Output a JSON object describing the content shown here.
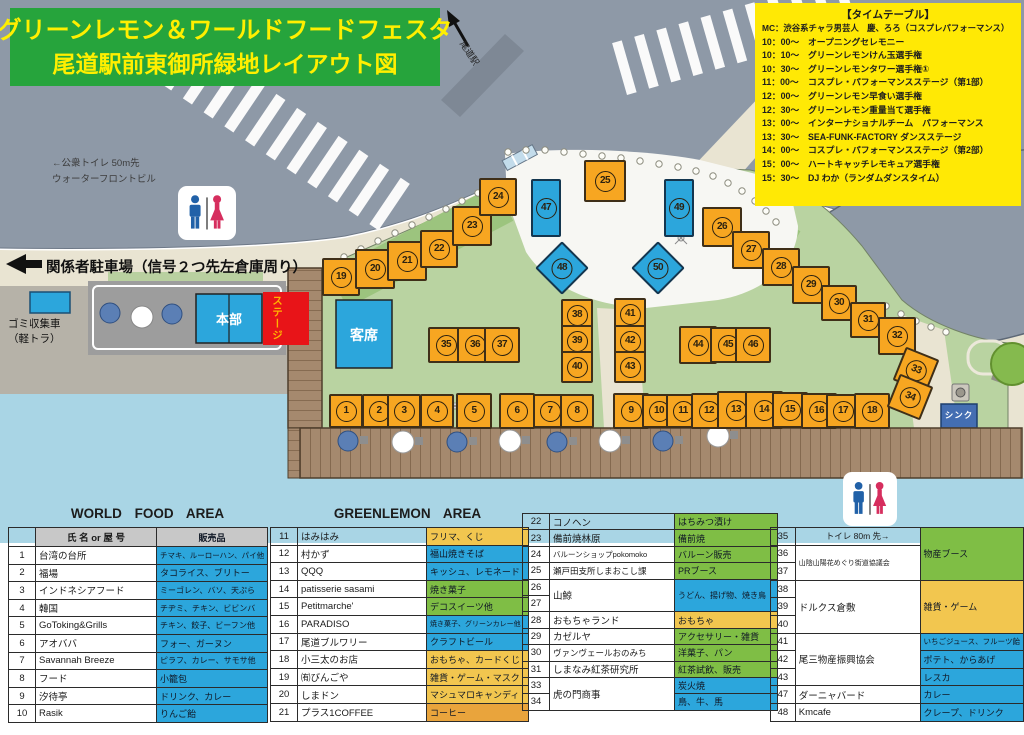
{
  "title": {
    "line1": "グリーンレモン＆ワールドフードフェスタ",
    "line2": "尾道駅前東御所緑地レイアウト図"
  },
  "timetable": {
    "heading": "【タイムテーブル】",
    "mc": "MC：渋谷系チャラ男芸人　慶、ろろ（コスプレパフォーマンス）",
    "entries": [
      {
        "time": "10：00～",
        "event": "オープニングセレモニー"
      },
      {
        "time": "10：10～",
        "event": "グリーンレモンけん玉選手権"
      },
      {
        "time": "10：30～",
        "event": "グリーンレモンタワー選手権①"
      },
      {
        "time": "11：00～",
        "event": "コスプレ・パフォーマンスステージ（第1部）"
      },
      {
        "time": "12：00～",
        "event": "グリーンレモン早食い選手権"
      },
      {
        "time": "12：30～",
        "event": "グリーンレモン重量当て選手権"
      },
      {
        "time": "13：00～",
        "event": "インターナショナルチーム　パフォーマンス"
      },
      {
        "time": "13：30～",
        "event": "SEA-FUNK-FACTORY ダンスステージ"
      },
      {
        "time": "14：00～",
        "event": "コスプレ・パフォーマンスステージ（第2部）"
      },
      {
        "time": "15：00～",
        "event": "ハートキャッチレモキュア選手権"
      },
      {
        "time": "15：30～",
        "event": "DJ わか（ランダムダンスタイム）"
      }
    ]
  },
  "map": {
    "labels": {
      "public_toilet_line1": "←公衆トイレ 50m先",
      "public_toilet_line2": "ウォーターフロントビル",
      "staff_parking": "関係者駐車場（信号２つ先左倉庫周り）",
      "garbage_truck_line1": "ゴミ収集車",
      "garbage_truck_line2": "（軽トラ）",
      "headquarters": "本部",
      "stage": "ステージ",
      "audience_seats": "客席",
      "sink": "シンク",
      "station": "尾道駅"
    },
    "booths": [
      {
        "n": 1,
        "x": 346,
        "y": 411,
        "s": 34,
        "k": "o"
      },
      {
        "n": 2,
        "x": 379,
        "y": 411,
        "s": 34,
        "k": "o"
      },
      {
        "n": 3,
        "x": 404,
        "y": 411,
        "s": 34,
        "k": "o"
      },
      {
        "n": 4,
        "x": 437,
        "y": 411,
        "s": 34,
        "k": "o"
      },
      {
        "n": 5,
        "x": 474,
        "y": 411,
        "s": 36,
        "k": "o"
      },
      {
        "n": 6,
        "x": 517,
        "y": 411,
        "s": 36,
        "k": "o"
      },
      {
        "n": 7,
        "x": 550,
        "y": 411,
        "s": 34,
        "k": "o"
      },
      {
        "n": 8,
        "x": 577,
        "y": 411,
        "s": 34,
        "k": "o"
      },
      {
        "n": 9,
        "x": 631,
        "y": 411,
        "s": 36,
        "k": "o"
      },
      {
        "n": 10,
        "x": 659,
        "y": 411,
        "s": 34,
        "k": "o"
      },
      {
        "n": 11,
        "x": 683,
        "y": 411,
        "s": 34,
        "k": "o"
      },
      {
        "n": 12,
        "x": 709,
        "y": 411,
        "s": 36,
        "k": "o"
      },
      {
        "n": 13,
        "x": 736,
        "y": 410,
        "s": 38,
        "k": "o"
      },
      {
        "n": 14,
        "x": 764,
        "y": 410,
        "s": 38,
        "k": "o"
      },
      {
        "n": 15,
        "x": 790,
        "y": 410,
        "s": 36,
        "k": "o"
      },
      {
        "n": 16,
        "x": 819,
        "y": 411,
        "s": 36,
        "k": "o"
      },
      {
        "n": 17,
        "x": 843,
        "y": 411,
        "s": 34,
        "k": "o"
      },
      {
        "n": 18,
        "x": 872,
        "y": 411,
        "s": 36,
        "k": "o"
      },
      {
        "n": 19,
        "x": 341,
        "y": 277,
        "s": 38,
        "k": "o"
      },
      {
        "n": 20,
        "x": 375,
        "y": 269,
        "s": 40,
        "k": "o"
      },
      {
        "n": 21,
        "x": 407,
        "y": 261,
        "s": 40,
        "k": "o"
      },
      {
        "n": 22,
        "x": 439,
        "y": 249,
        "s": 38,
        "k": "o"
      },
      {
        "n": 23,
        "x": 472,
        "y": 226,
        "s": 40,
        "k": "o"
      },
      {
        "n": 24,
        "x": 498,
        "y": 197,
        "s": 38,
        "k": "o"
      },
      {
        "n": 25,
        "x": 605,
        "y": 181,
        "s": 42,
        "k": "o"
      },
      {
        "n": 26,
        "x": 722,
        "y": 227,
        "s": 40,
        "k": "o"
      },
      {
        "n": 27,
        "x": 751,
        "y": 250,
        "s": 38,
        "k": "o"
      },
      {
        "n": 28,
        "x": 781,
        "y": 267,
        "s": 38,
        "k": "o"
      },
      {
        "n": 29,
        "x": 811,
        "y": 285,
        "s": 38,
        "k": "o"
      },
      {
        "n": 30,
        "x": 839,
        "y": 303,
        "s": 36,
        "k": "o"
      },
      {
        "n": 31,
        "x": 868,
        "y": 320,
        "s": 36,
        "k": "o"
      },
      {
        "n": 32,
        "x": 897,
        "y": 336,
        "s": 38,
        "k": "o"
      },
      {
        "n": 33,
        "x": 916,
        "y": 370,
        "s": 36,
        "k": "o",
        "rot": 22
      },
      {
        "n": 34,
        "x": 910,
        "y": 397,
        "s": 36,
        "k": "o",
        "rot": 22
      },
      {
        "n": 35,
        "x": 446,
        "y": 345,
        "s": 36,
        "k": "o"
      },
      {
        "n": 36,
        "x": 475,
        "y": 345,
        "s": 36,
        "k": "o"
      },
      {
        "n": 37,
        "x": 502,
        "y": 345,
        "s": 36,
        "k": "o"
      },
      {
        "n": 38,
        "x": 577,
        "y": 315,
        "s": 32,
        "k": "o"
      },
      {
        "n": 39,
        "x": 577,
        "y": 341,
        "s": 32,
        "k": "o"
      },
      {
        "n": 40,
        "x": 577,
        "y": 367,
        "s": 32,
        "k": "o"
      },
      {
        "n": 41,
        "x": 630,
        "y": 314,
        "s": 32,
        "k": "o"
      },
      {
        "n": 42,
        "x": 630,
        "y": 341,
        "s": 32,
        "k": "o"
      },
      {
        "n": 43,
        "x": 630,
        "y": 367,
        "s": 32,
        "k": "o"
      },
      {
        "n": 44,
        "x": 698,
        "y": 345,
        "s": 38,
        "k": "o"
      },
      {
        "n": 45,
        "x": 728,
        "y": 345,
        "s": 36,
        "k": "o"
      },
      {
        "n": 46,
        "x": 753,
        "y": 345,
        "s": 36,
        "k": "o"
      },
      {
        "n": 47,
        "x": 546,
        "y": 208,
        "k": "r"
      },
      {
        "n": 48,
        "x": 562,
        "y": 268,
        "k": "d"
      },
      {
        "n": 49,
        "x": 679,
        "y": 208,
        "k": "r"
      },
      {
        "n": 50,
        "x": 658,
        "y": 268,
        "k": "d"
      }
    ]
  },
  "tables": [
    {
      "title": "WORLD FOOD AREA",
      "header": {
        "name": "氏 名 or 屋 号",
        "items": "販売品"
      },
      "rows": [
        {
          "num": "1",
          "name": {
            "t": "台湾の台所"
          },
          "prod": {
            "t": "チマキ、ルーローハン、パイ他",
            "c": "blue",
            "fs": 7.5
          }
        },
        {
          "num": "2",
          "name": {
            "t": "福場"
          },
          "prod": {
            "t": "タコライス、ブリトー",
            "c": "blue"
          }
        },
        {
          "num": "3",
          "name": {
            "t": "インドネシアフード"
          },
          "prod": {
            "t": "ミーゴレン、バソ、天ぷら",
            "c": "blue",
            "fs": 8
          }
        },
        {
          "num": "4",
          "name": {
            "t": "韓国"
          },
          "prod": {
            "t": "チヂミ、チキン、ビビンバ",
            "c": "blue",
            "fs": 8
          }
        },
        {
          "num": "5",
          "name": {
            "t": "GoToking&Grills"
          },
          "prod": {
            "t": "チキン、餃子、ビーフン他",
            "c": "blue",
            "fs": 8
          }
        },
        {
          "num": "6",
          "name": {
            "t": "アオババ"
          },
          "prod": {
            "t": "フォー、ガーヌン",
            "c": "blue"
          }
        },
        {
          "num": "7",
          "name": {
            "t": "Savannah Breeze"
          },
          "prod": {
            "t": "ピラフ、カレー、サモサ他",
            "c": "blue",
            "fs": 8
          }
        },
        {
          "num": "8",
          "name": {
            "t": "フード"
          },
          "prod": {
            "t": "小籠包",
            "c": "blue"
          }
        },
        {
          "num": "9",
          "name": {
            "t": "汐待亭"
          },
          "prod": {
            "t": "ドリンク、カレー",
            "c": "blue"
          }
        },
        {
          "num": "10",
          "name": {
            "t": "Rasik"
          },
          "prod": {
            "t": "りんご飴",
            "c": "blue"
          }
        }
      ]
    },
    {
      "title": "GREENLEMON AREA",
      "rows": [
        {
          "num": "11",
          "name": {
            "t": "はみはみ"
          },
          "prod": {
            "t": "フリマ、くじ",
            "c": "yellow"
          }
        },
        {
          "num": "12",
          "name": {
            "t": "村かず"
          },
          "prod": {
            "t": "福山焼きそば",
            "c": "blue"
          }
        },
        {
          "num": "13",
          "name": {
            "t": "QQQ"
          },
          "prod": {
            "t": "キッシュ、レモネード",
            "c": "blue"
          }
        },
        {
          "num": "14",
          "name": {
            "t": "patisserie sasami"
          },
          "prod": {
            "t": "焼き菓子",
            "c": "green"
          }
        },
        {
          "num": "15",
          "name": {
            "t": "Petitmarche'"
          },
          "prod": {
            "t": "デコスイーツ他",
            "c": "green"
          }
        },
        {
          "num": "16",
          "name": {
            "t": "PARADISO"
          },
          "prod": {
            "t": "焼き菓子、グリーンカレー他",
            "c": "blue",
            "fs": 7
          }
        },
        {
          "num": "17",
          "name": {
            "t": "尾道ブルワリー"
          },
          "prod": {
            "t": "クラフトビール",
            "c": "blue"
          }
        },
        {
          "num": "18",
          "name": {
            "t": "小三太のお店"
          },
          "prod": {
            "t": "おもちゃ、カードくじ",
            "c": "yellow"
          }
        },
        {
          "num": "19",
          "name": {
            "t": "㈲びんごや"
          },
          "prod": {
            "t": "雑貨・ゲーム・マスク",
            "c": "yellow"
          }
        },
        {
          "num": "20",
          "name": {
            "t": "しまドン"
          },
          "prod": {
            "t": "マシュマロキャンディ",
            "c": "yellow"
          }
        },
        {
          "num": "21",
          "name": {
            "t": "プラス1COFFEE"
          },
          "prod": {
            "t": "コーヒー",
            "c": "orange"
          }
        }
      ]
    },
    {
      "rows": [
        {
          "num": "22",
          "name": {
            "t": "コノヘン"
          },
          "prod": {
            "t": "はちみつ漬け",
            "c": "green"
          }
        },
        {
          "num": "23",
          "name": {
            "t": "備前焼林原"
          },
          "prod": {
            "t": "備前焼",
            "c": "green"
          }
        },
        {
          "num": "24",
          "name": {
            "t": "バルーンショップpokomoko",
            "fs": 7.5
          },
          "prod": {
            "t": "バルーン販売",
            "c": "green"
          }
        },
        {
          "num": "25",
          "name": {
            "t": "瀬戸田支所しまおこし課",
            "fs": 8.5
          },
          "prod": {
            "t": "PRブース",
            "c": "green"
          }
        },
        {
          "num": "26",
          "name": {
            "t": "山鯨",
            "rs": 2
          },
          "prod": {
            "t": "うどん、揚げ物、焼き鳥",
            "c": "blue",
            "rs": 2,
            "fs": 8
          }
        },
        {
          "num": "27"
        },
        {
          "num": "28",
          "name": {
            "t": "おもちゃランド"
          },
          "prod": {
            "t": "おもちゃ",
            "c": "yellow"
          }
        },
        {
          "num": "29",
          "name": {
            "t": "カゼルヤ"
          },
          "prod": {
            "t": "アクセサリー・雑貨",
            "c": "green"
          }
        },
        {
          "num": "30",
          "name": {
            "t": "ヴァンヴェールおのみち",
            "fs": 8.5
          },
          "prod": {
            "t": "洋菓子、パン",
            "c": "green"
          }
        },
        {
          "num": "31",
          "name": {
            "t": "しまなみ紅茶研究所"
          },
          "prod": {
            "t": "紅茶試飲、販売",
            "c": "green"
          }
        },
        {
          "num": "33",
          "name": {
            "t": "虎の門商事",
            "rs": 2
          },
          "prod": {
            "t": "炭火焼",
            "c": "blue"
          }
        },
        {
          "num": "34",
          "prod": {
            "t": "鳥、牛、馬",
            "c": "blue"
          }
        }
      ]
    },
    {
      "rows": [
        {
          "num": "35",
          "name": {
            "t": "トイレ 80m 先→",
            "note": true
          },
          "prod": {
            "t": "物産ブース",
            "c": "green",
            "rs": 3
          }
        },
        {
          "num": "36",
          "name": {
            "t": "山陰山陽花めぐり街道協議会",
            "rs": 2,
            "fs": 7
          }
        },
        {
          "num": "37"
        },
        {
          "num": "38",
          "name": {
            "t": "ドルクス倉敷",
            "rs": 3
          },
          "prod": {
            "t": "雑貨・ゲーム",
            "c": "yellow",
            "rs": 3
          }
        },
        {
          "num": "39"
        },
        {
          "num": "40"
        },
        {
          "num": "41",
          "name": {
            "t": "尾三物産振興協会",
            "rs": 3
          },
          "prod": {
            "t": "いちごジュース、フルーツ飴",
            "c": "blue",
            "fs": 7.5
          }
        },
        {
          "num": "42",
          "prod": {
            "t": "ポテト、からあげ",
            "c": "blue"
          }
        },
        {
          "num": "43",
          "prod": {
            "t": "レスカ",
            "c": "blue"
          }
        },
        {
          "num": "47",
          "name": {
            "t": "ダーニャバード"
          },
          "prod": {
            "t": "カレー",
            "c": "blue"
          }
        },
        {
          "num": "48",
          "name": {
            "t": "Kmcafe"
          },
          "prod": {
            "t": "クレープ、ドリンク",
            "c": "blue"
          }
        }
      ]
    }
  ],
  "colors": {
    "banner_green": "#26a43c",
    "banner_text": "#ffef00",
    "timetable_yellow": "#ffe905",
    "booth_orange": "#f7a621",
    "booth_blue": "#2ca6dc",
    "stage_red": "#e81418",
    "cell_blue": "#2ca6dc",
    "cell_green": "#7fbe45",
    "cell_yellow": "#f2c64f",
    "cell_orange": "#e9a43c"
  }
}
